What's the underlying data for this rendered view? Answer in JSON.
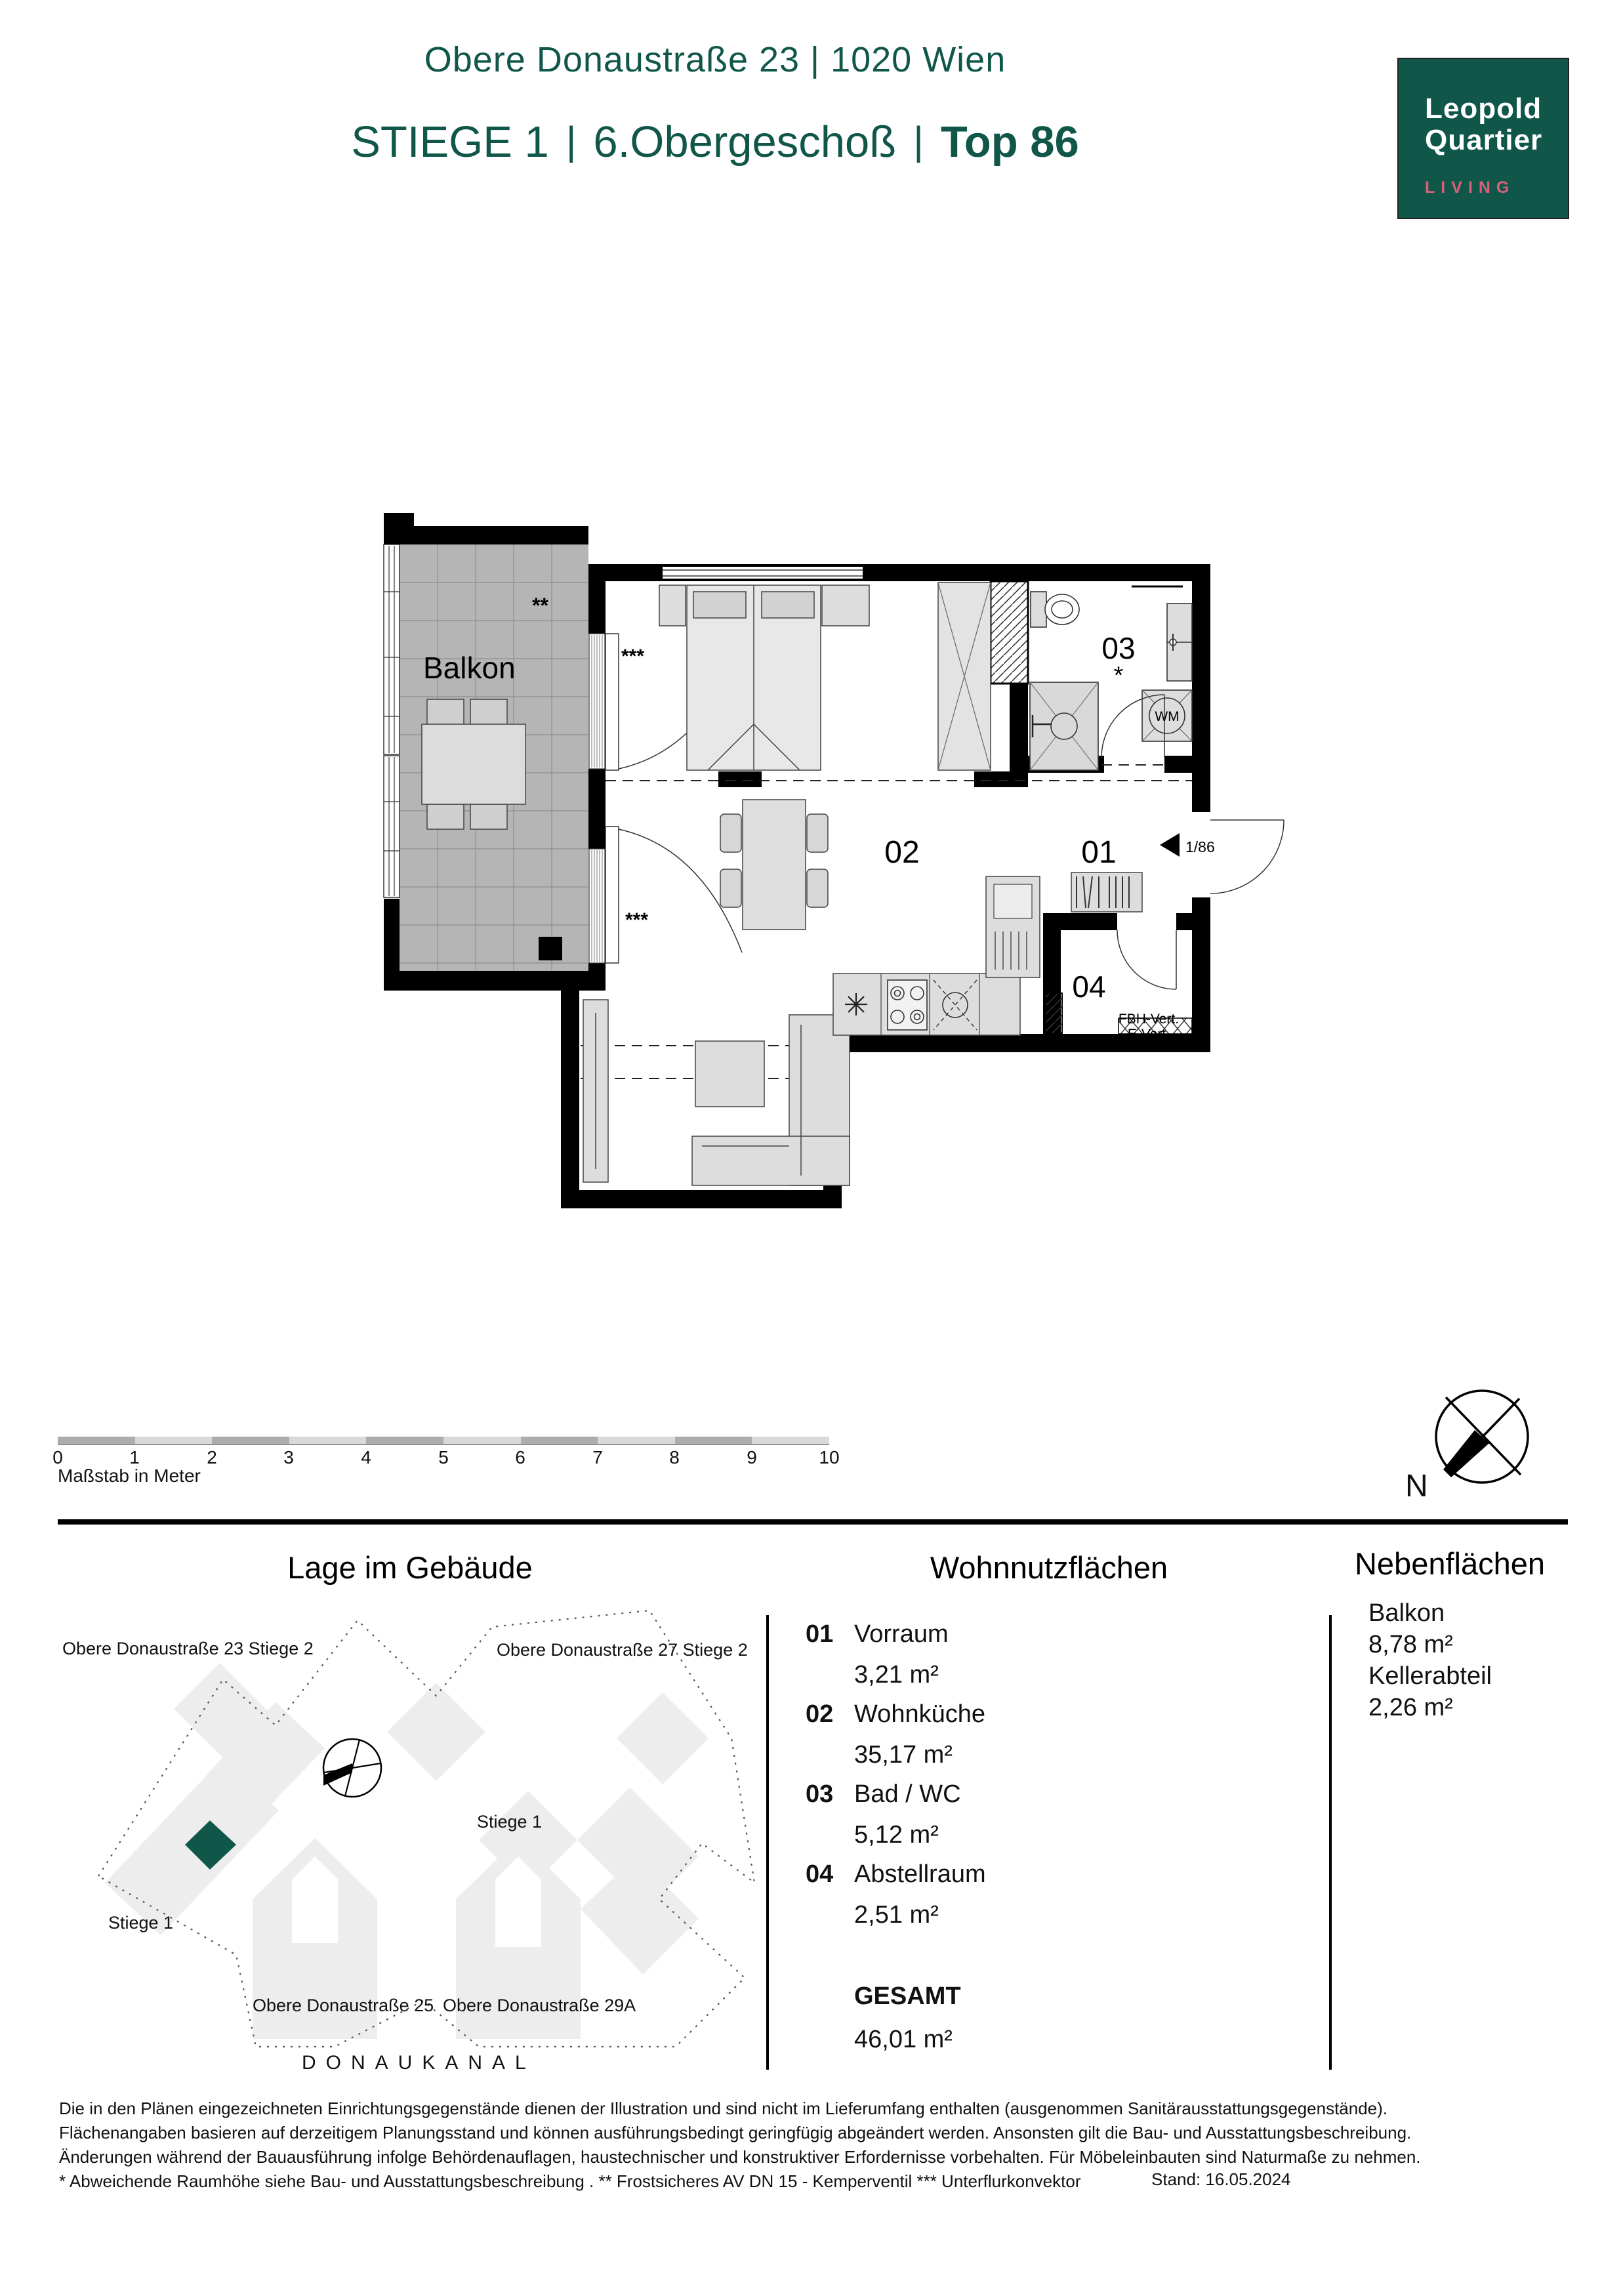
{
  "colors": {
    "brand_green": "#10574A",
    "accent_pink": "#D96079"
  },
  "header": {
    "address": "Obere Donaustraße 23 | 1020 Wien",
    "stiege": "STIEGE 1",
    "sep": "|",
    "floor": "6.Obergeschoß",
    "top": "Top 86"
  },
  "logo": {
    "line1": "Leopold",
    "line2": "Quartier",
    "line3": "LIVING"
  },
  "plan": {
    "balkon": "Balkon",
    "room01": "01",
    "room02": "02",
    "room03": "03",
    "room04": "04",
    "wm": "WM",
    "entry_ref": "1/86",
    "fbh": "FBH-Vert.",
    "evert": "E-Vert.",
    "star": "*",
    "star2": "**",
    "star3": "***"
  },
  "scalebar": {
    "ticks": [
      "0",
      "1",
      "2",
      "3",
      "4",
      "5",
      "6",
      "7",
      "8",
      "9",
      "10"
    ],
    "caption": "Maßstab in Meter"
  },
  "compass": {
    "north": "N"
  },
  "site": {
    "title": "Lage im Gebäude",
    "bldg23": "Obere Donaustraße 23 Stiege 2",
    "bldg27": "Obere Donaustraße 27 Stiege 2",
    "stiege1_right": "Stiege 1",
    "stiege1_left": "Stiege 1",
    "bldg25": "Obere Donaustraße 25",
    "bldg29a": "Obere Donaustraße 29A",
    "canal": "DONAUKANAL"
  },
  "areas": {
    "wohn_title": "Wohnnutzflächen",
    "items": [
      {
        "num": "01",
        "name": "Vorraum",
        "area": "3,21 m²"
      },
      {
        "num": "02",
        "name": "Wohnküche",
        "area": "35,17 m²"
      },
      {
        "num": "03",
        "name": "Bad / WC",
        "area": "5,12 m²"
      },
      {
        "num": "04",
        "name": "Abstellraum",
        "area": "2,51 m²"
      }
    ],
    "gesamt_label": "GESAMT",
    "gesamt_area": "46,01 m²",
    "neben_title": "Nebenflächen",
    "neben": [
      {
        "name": "Balkon",
        "area": "8,78 m²"
      },
      {
        "name": "Kellerabteil",
        "area": "2,26 m²"
      }
    ]
  },
  "footer": {
    "line1": "Die in den Plänen eingezeichneten Einrichtungsgegenstände dienen der Illustration und sind nicht im Lieferumfang enthalten (ausgenommen Sanitärausstattungsgegenstände).",
    "line2": "Flächenangaben basieren auf derzeitigem Planungsstand und können ausführungsbedingt geringfügig abgeändert werden. Ansonsten gilt die Bau- und Ausstattungsbeschreibung.",
    "line3": "Änderungen während der Bauausführung infolge Behördenauflagen, haustechnischer und konstruktiver Erfordernisse vorbehalten. Für Möbeleinbauten sind Naturmaße zu nehmen.",
    "line4": "* Abweichende Raumhöhe siehe Bau- und Ausstattungsbeschreibung . ** Frostsicheres AV DN 15 - Kemperventil  *** Unterflurkonvektor",
    "stand": "Stand: 16.05.2024"
  }
}
